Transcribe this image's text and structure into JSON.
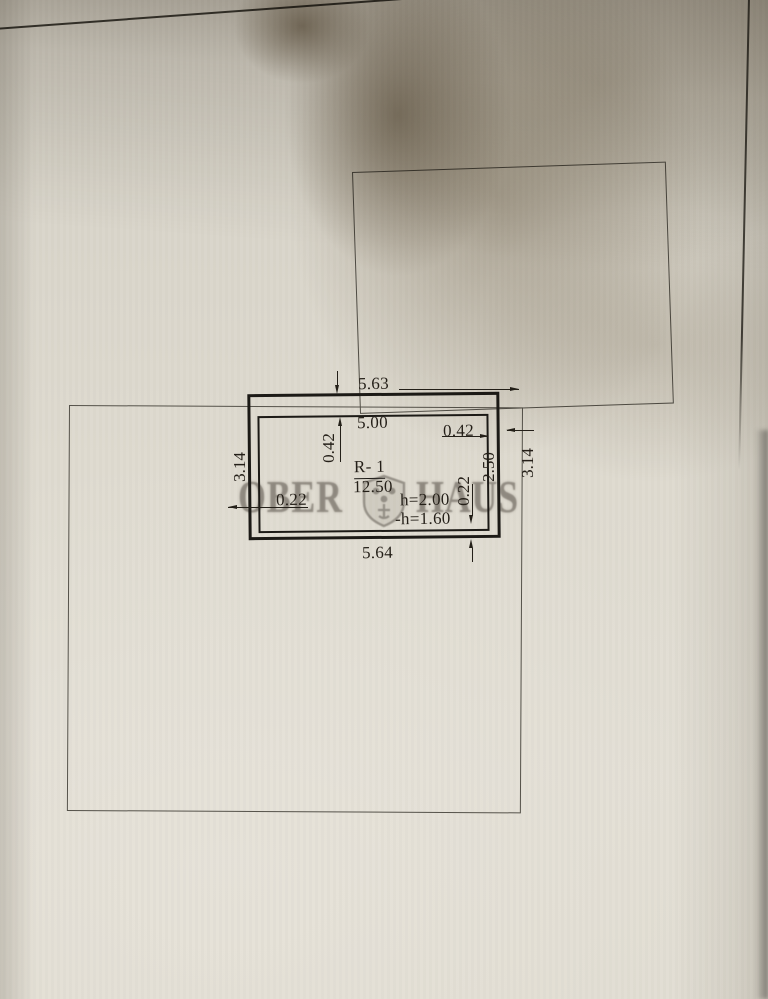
{
  "document_type": "floor plan photo",
  "watermark": {
    "left": "OBER",
    "right": "HAUS",
    "logo": "shield-icon"
  },
  "room": {
    "name": "R- 1",
    "area": "12.50",
    "height": "h=2.00",
    "height_reduced": "-h=1.60"
  },
  "dims": {
    "top_outer": "5.63",
    "top_inner": "5.00",
    "wall_top_left": "0.42",
    "wall_top_right": "0.42",
    "side_left": "3.14",
    "side_right": "3.14",
    "inner_height": "2.50",
    "wall_left": "0.22",
    "wall_right": "0.22",
    "bottom_outer": "5.64"
  },
  "colors": {
    "paper": "#dfdbd0",
    "heavy_line": "#1c1a16",
    "thin_line": "#524f47",
    "watermark": "#58524a",
    "shadow": "#746856"
  }
}
